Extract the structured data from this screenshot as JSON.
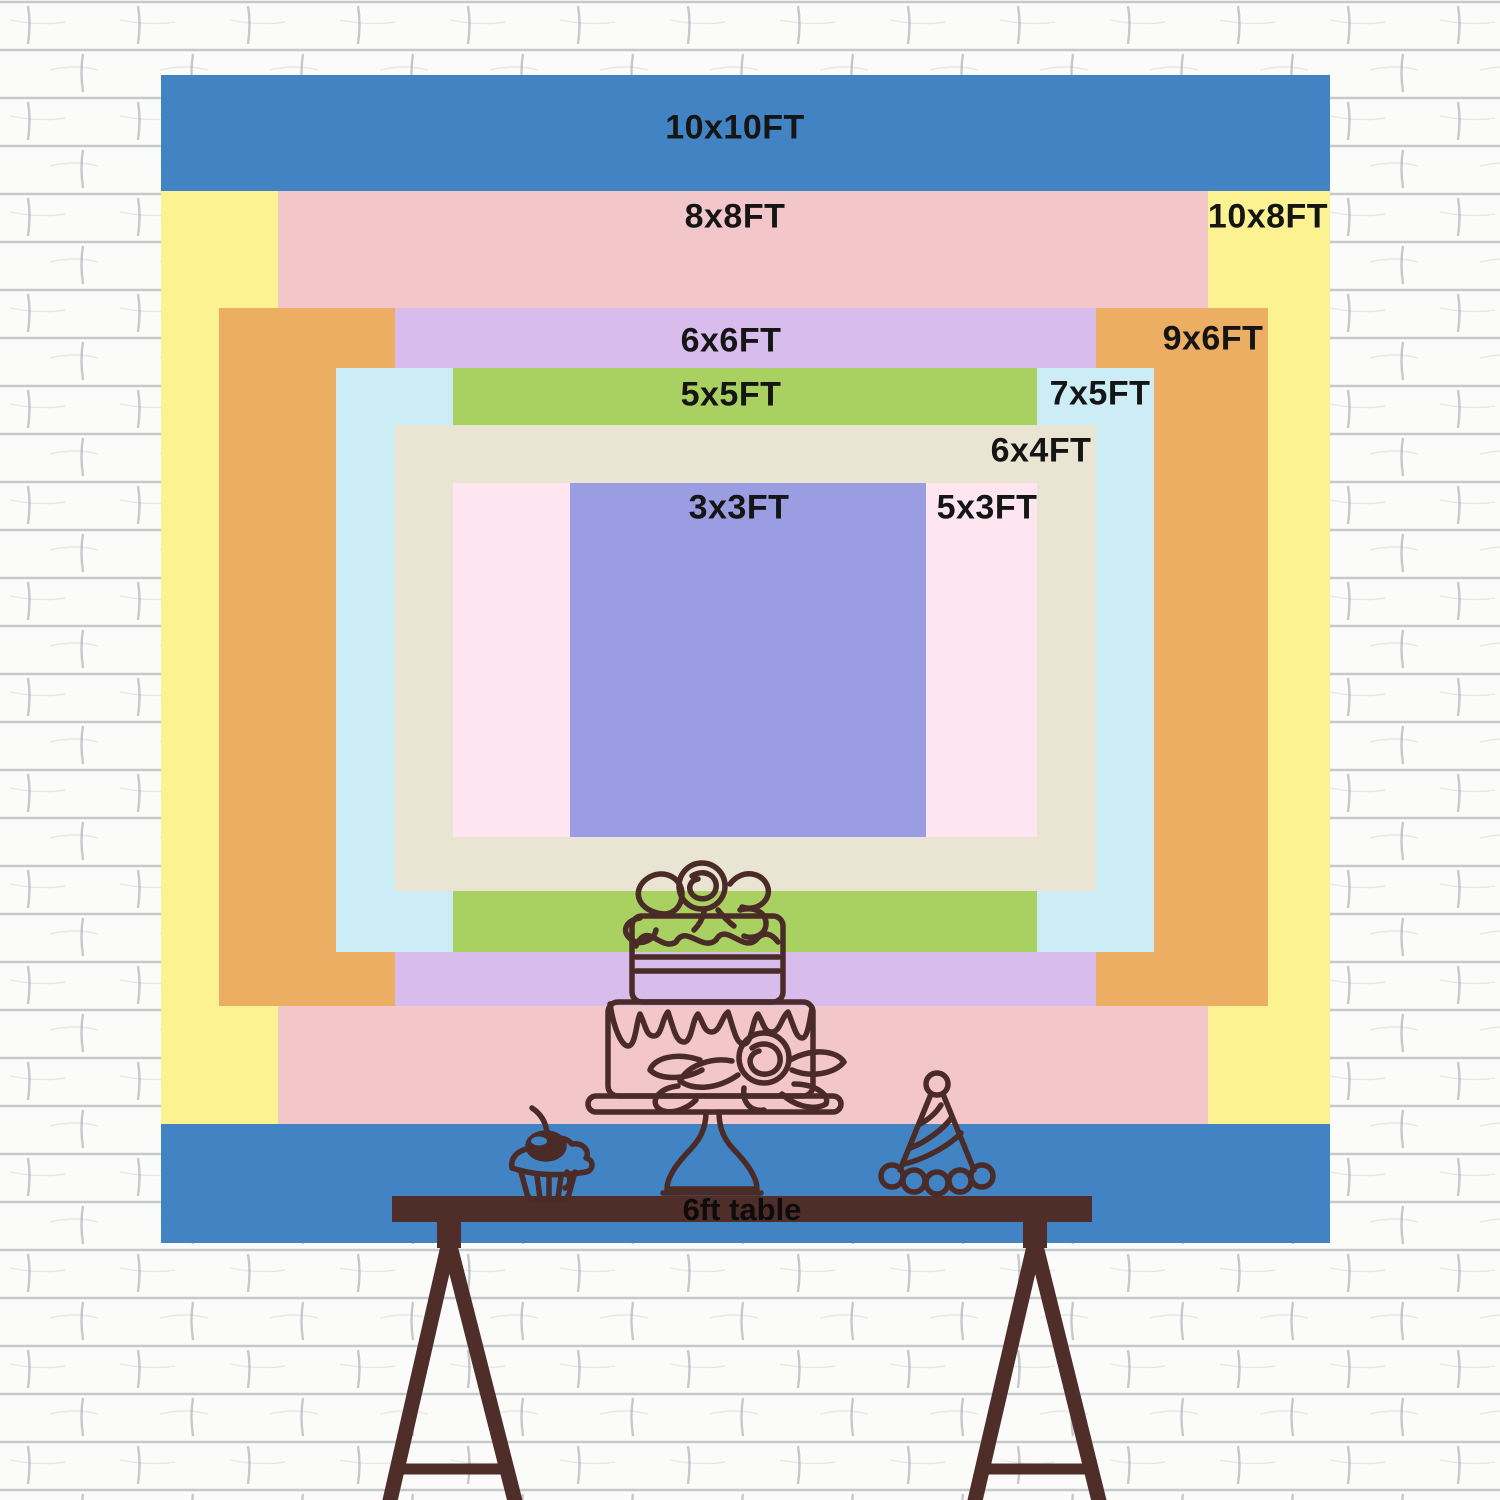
{
  "sizes": [
    {
      "label": "10x10FT",
      "width_ft": 10,
      "height_ft": 10,
      "color": "#4183c3"
    },
    {
      "label": "10x8FT",
      "width_ft": 10,
      "height_ft": 8,
      "color": "#fcf292"
    },
    {
      "label": "8x8FT",
      "width_ft": 8,
      "height_ft": 8,
      "color": "#f3c7c9"
    },
    {
      "label": "9x6FT",
      "width_ft": 9,
      "height_ft": 6,
      "color": "#ecae63"
    },
    {
      "label": "6x6FT",
      "width_ft": 6,
      "height_ft": 6,
      "color": "#d8bdec"
    },
    {
      "label": "7x5FT",
      "width_ft": 7,
      "height_ft": 5,
      "color": "#cdedf6"
    },
    {
      "label": "5x5FT",
      "width_ft": 5,
      "height_ft": 5,
      "color": "#a9d161"
    },
    {
      "label": "6x4FT",
      "width_ft": 6,
      "height_ft": 4,
      "color": "#eae4d2"
    },
    {
      "label": "5x3FT",
      "width_ft": 5,
      "height_ft": 3,
      "color": "#fde6f0"
    },
    {
      "label": "3x3FT",
      "width_ft": 3,
      "height_ft": 3,
      "color": "#9b9de2"
    }
  ],
  "table": {
    "label": "6ft table",
    "color": "#4f2e2a"
  },
  "artwork": {
    "stroke_color": "#4a2b27",
    "items": [
      "tiered-cake",
      "cupcake-with-cherry",
      "party-hat"
    ]
  },
  "wall": {
    "base_color": "#fbfbf9",
    "mortar_color": "#9aa0a8"
  },
  "label_text_color": "#151515"
}
